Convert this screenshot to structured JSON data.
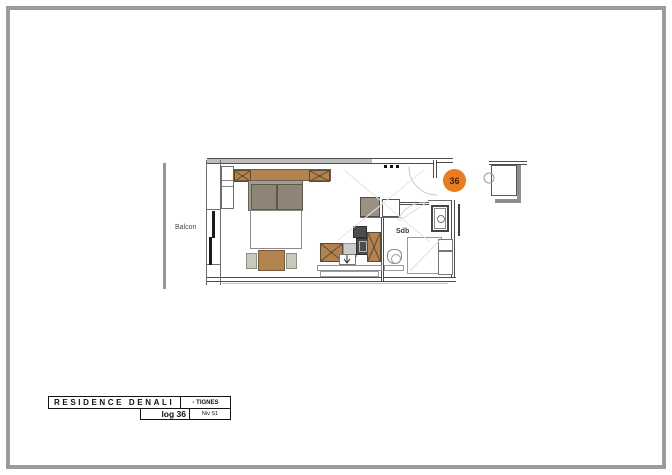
{
  "plan": {
    "balcony_label": "Balcon",
    "bathroom_label": "Sdb",
    "unit_number": "36"
  },
  "title_block": {
    "residence_name": "RESIDENCE DENALI",
    "location": "- TIGNES",
    "unit": "log 36",
    "level": "Niv S1"
  },
  "colors": {
    "unit_badge": "#e87c1f",
    "wood_brown": "#b2834e",
    "pillow_taupe": "#968c7e",
    "chair_sage": "#c7cab8",
    "appliance_dark": "#4d4d4d",
    "frame_border": "#9b9b9b"
  }
}
